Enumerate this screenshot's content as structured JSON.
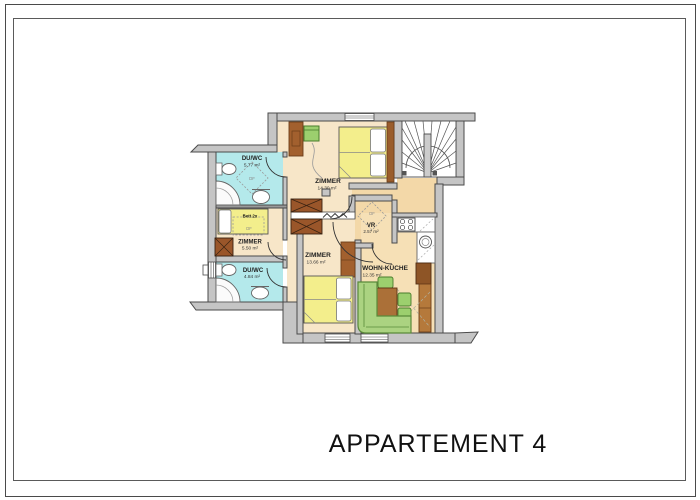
{
  "title": "APPARTEMENT 4",
  "rooms": {
    "bath_top": {
      "name": "DU/WC",
      "area": "5.77 m²",
      "skylight": "DF"
    },
    "bedroom_top": {
      "name": "ZIMMER",
      "area": "14.30 m²"
    },
    "bedroom_left": {
      "name": "ZIMMER",
      "area": "5.50 m²",
      "bed_label": "Bett 2x",
      "skylight": "DF"
    },
    "bath_bottom": {
      "name": "DU/WC",
      "area": "4.84 m²"
    },
    "bedroom_bottom": {
      "name": "ZIMMER",
      "area": "13.66 m²"
    },
    "vestibule": {
      "name": "VR",
      "area": "2.57 m²",
      "skylight": "DF"
    },
    "living_kitchen": {
      "name": "WOHN-KÜCHE",
      "area": "12.35 m²"
    }
  },
  "colors": {
    "wall": "#c5c5c5",
    "wall_outline": "#4a4a4a",
    "room_floor": "#f7e6c8",
    "hall_floor": "#f3d8a8",
    "kitchen_floor": "#f6e0b6",
    "bath_floor": "#b4e9eb",
    "bed_yellow": "#f3ee8c",
    "furniture_brown": "#9a562a",
    "furniture_green": "#9ccf6e",
    "sofa_green": "#abd381"
  }
}
